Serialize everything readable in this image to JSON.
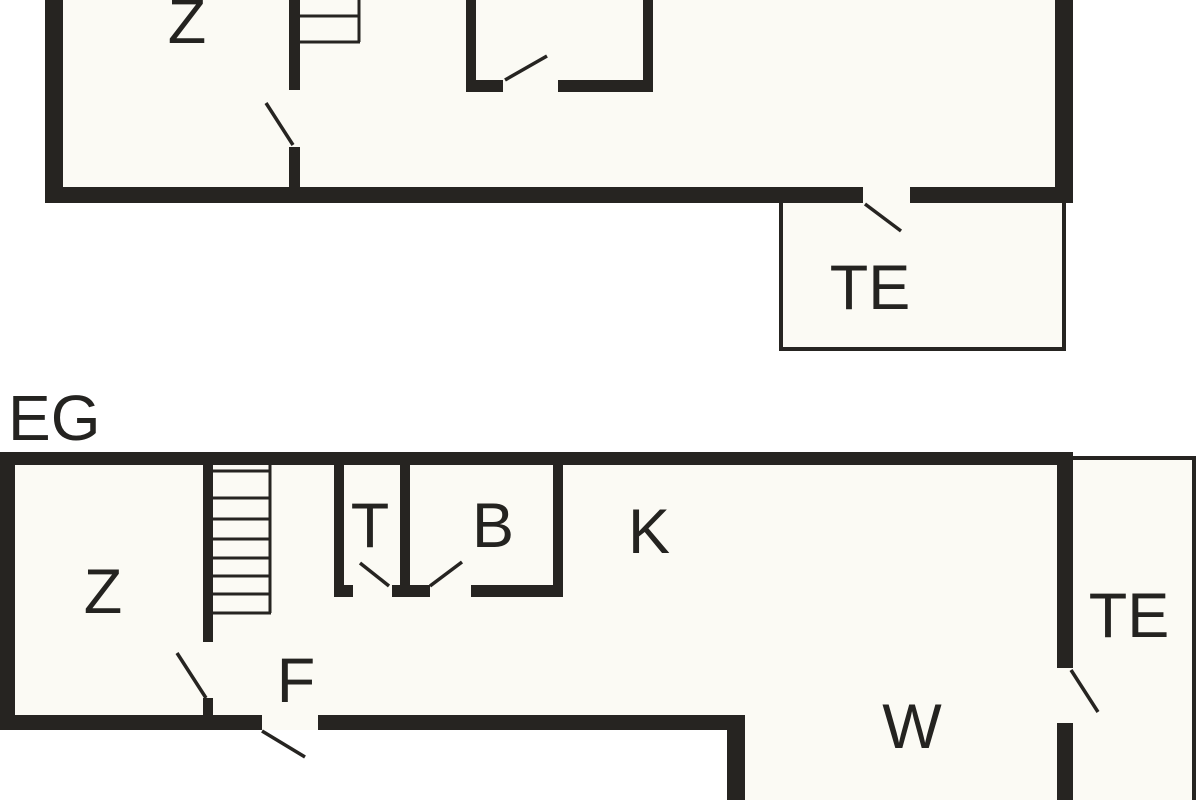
{
  "colors": {
    "wall": "#262421",
    "text": "#242320",
    "room_fill": "#fbfaf4",
    "background": "#ffffff"
  },
  "upper_floor": {
    "rooms": {
      "z": "Z",
      "te": "TE"
    }
  },
  "ground_floor": {
    "label": "EG",
    "rooms": {
      "z": "Z",
      "t": "T",
      "b": "B",
      "k": "K",
      "f": "F",
      "w": "W",
      "te": "TE"
    }
  }
}
